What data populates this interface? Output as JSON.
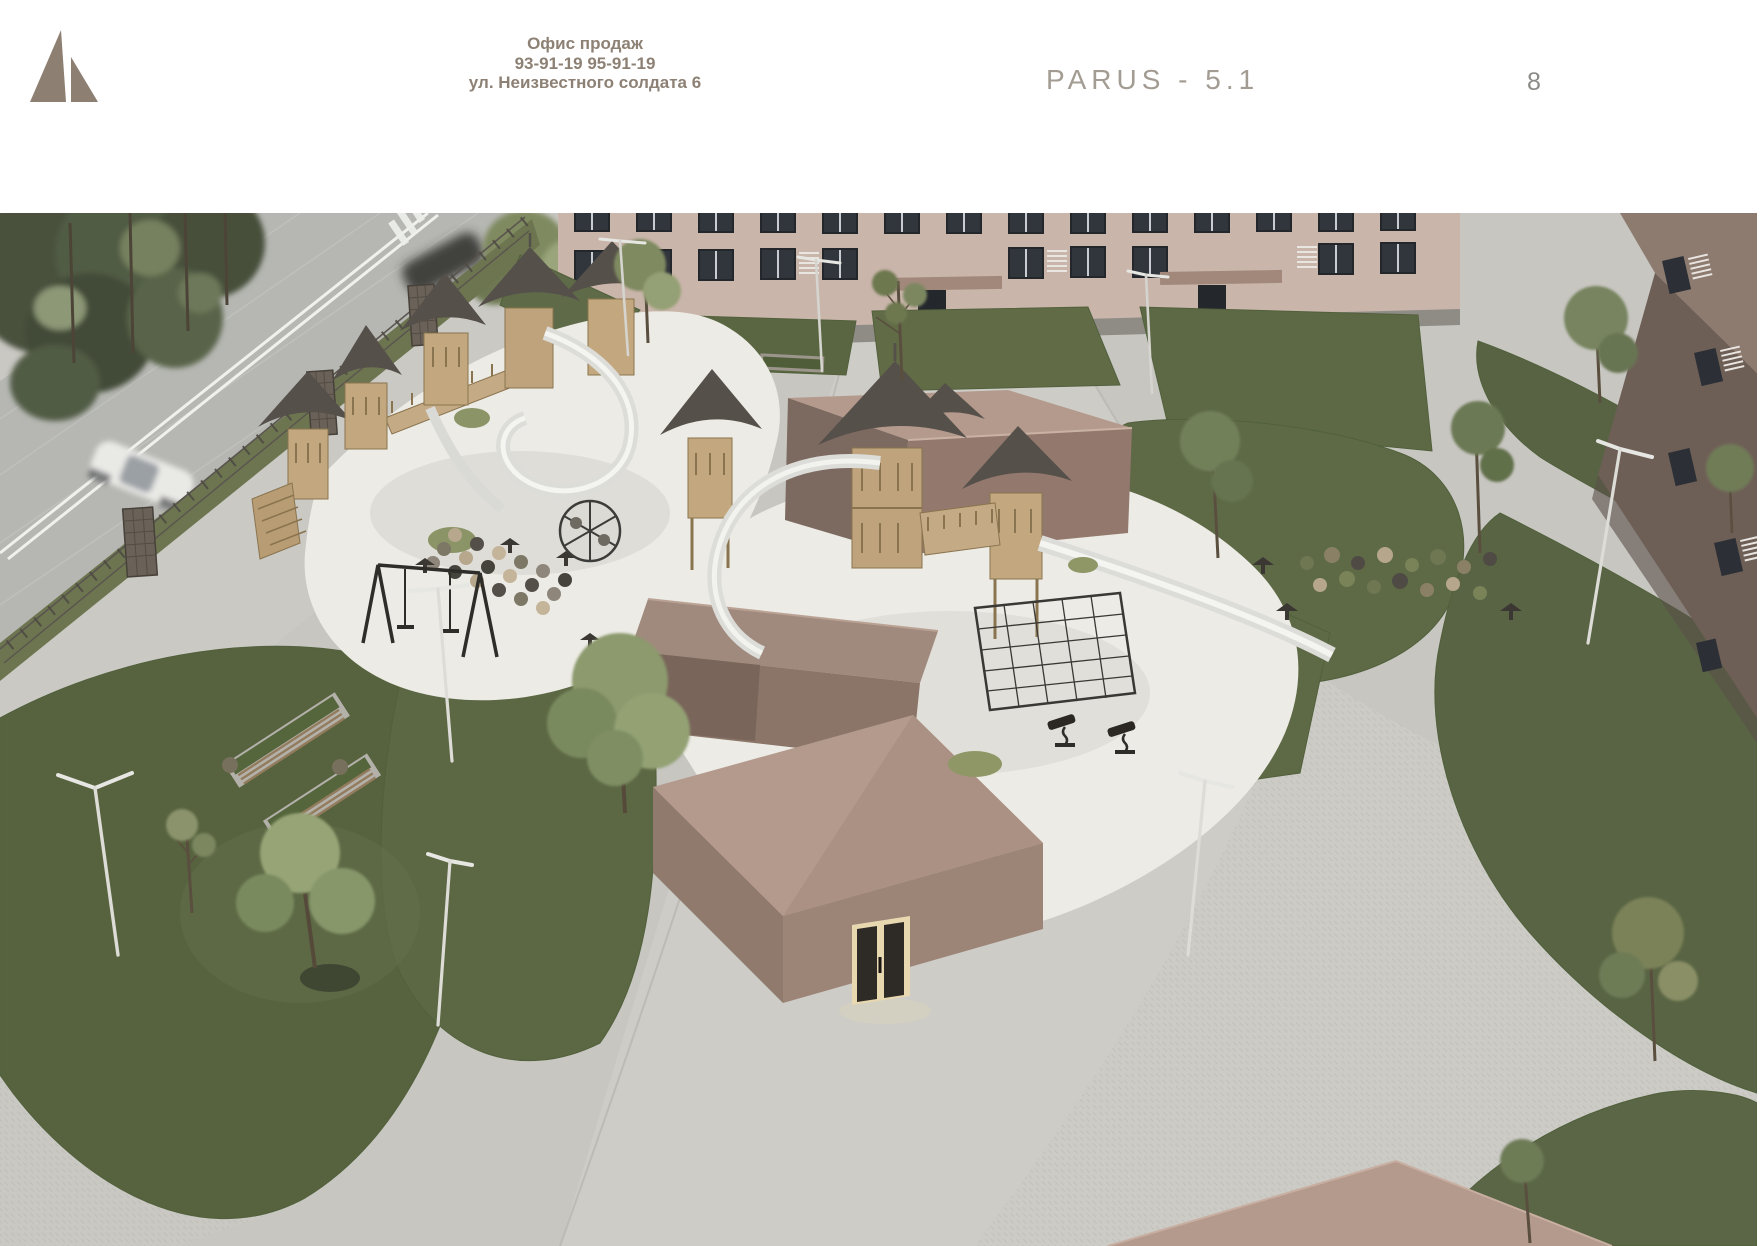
{
  "header": {
    "office": {
      "line1": "Офис продаж",
      "line2": "93-91-19  95-91-19",
      "line3": "ул. Неизвестного солдата 6"
    },
    "title": "PARUS - 5.1",
    "page_number": "8"
  },
  "scene": {
    "description": "Aerial 3D architectural render of a residential courtyard: street with cars and fence, two wooden playground complexes with tower slides, flat-roofed pavilions, lawns, paved walkways, benches and street lamps in front of beige apartment buildings",
    "palette": {
      "page_bg": "#ffffff",
      "brand": "#8d7f72",
      "title_gray": "#a39c93",
      "pavement": "#c7c6c1",
      "plaza": "#cccbc6",
      "road": "#b6b7b3",
      "road_line": "#f0f0ec",
      "sidewalk": "#c9c8c3",
      "verge": "#6c7550",
      "lawn": "#5d6945",
      "lawn_dark": "#57633e",
      "tree_dark": "#49513d",
      "tree_light": "#8c9a6d",
      "playground_surface": "#ecebe5",
      "wood": "#c3a87f",
      "roof": "#56504a",
      "slide": "#dcdcd9",
      "facade": "#c9b5aa",
      "facade_dark": "#6e5f56",
      "window": "#31363c",
      "pavilion_top": "#b49a8c",
      "pavilion_face": "#9c8477",
      "pavilion_dark": "#8f7a6d",
      "door_light": "#e8d8b0",
      "metal_dark": "#2f2d2a"
    }
  }
}
